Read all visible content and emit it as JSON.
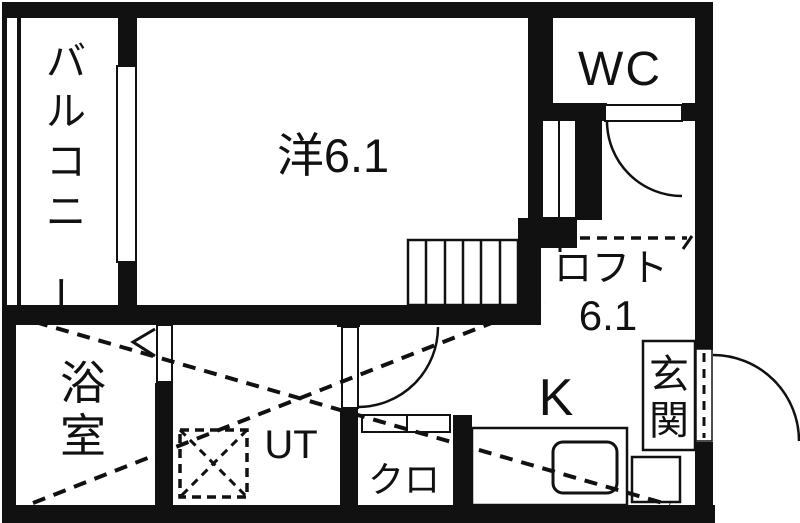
{
  "plan": {
    "type": "floor-plan",
    "background": "#ffffff",
    "wall_color": "#111111",
    "rooms": {
      "balcony": {
        "label": "バルコニー"
      },
      "western": {
        "label": "洋6.1"
      },
      "wc": {
        "label": "WC"
      },
      "loft": {
        "label": "ロフト",
        "area": "6.1"
      },
      "bath": {
        "label": "浴室"
      },
      "ut": {
        "label": "UT"
      },
      "closet": {
        "label": "クロ"
      },
      "kitchen": {
        "label": "K"
      },
      "entrance": {
        "label": "玄関"
      }
    },
    "features": [
      "balcony-window",
      "staircase-6-steps",
      "wc-door-arc",
      "hall-door-arc",
      "bath-folding-door",
      "entrance-door-arc",
      "kitchen-sink",
      "washing-machine-space",
      "loft-dashed-outline",
      "closet-sliding-door"
    ]
  }
}
